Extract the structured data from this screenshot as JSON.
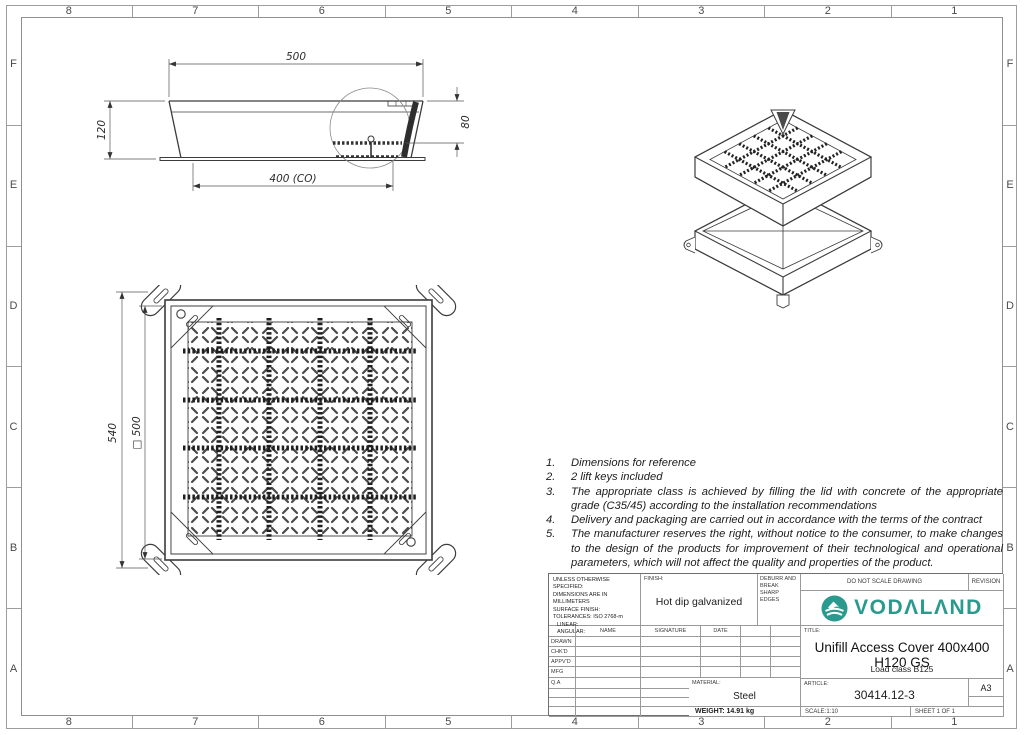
{
  "sheet": {
    "grid_columns": [
      "8",
      "7",
      "6",
      "5",
      "4",
      "3",
      "2",
      "1"
    ],
    "grid_rows": [
      "F",
      "E",
      "D",
      "C",
      "B",
      "A"
    ]
  },
  "views": {
    "side_view": {
      "dim_width_top": "500",
      "dim_height_left": "120",
      "dim_height_right": "80",
      "dim_clear_opening": "400 (CO)"
    },
    "plan_view": {
      "dim_outer_height": "540",
      "dim_inner_square": "□ 500"
    }
  },
  "notes": {
    "items": [
      {
        "num": "1.",
        "text": "Dimensions for reference"
      },
      {
        "num": "2.",
        "text": "2 lift keys included"
      },
      {
        "num": "3.",
        "text": "The appropriate class is achieved by filling the lid with concrete of the appropriate grade (C35/45) according to the installation recommendations"
      },
      {
        "num": "4.",
        "text": "Delivery and packaging are carried out in accordance with the terms of the contract"
      },
      {
        "num": "5.",
        "text": "The manufacturer reserves the right, without notice to the consumer, to make changes to the design of the products for improvement of their technological and operational parameters, which will not affect the quality and properties of the product."
      }
    ]
  },
  "title_block": {
    "tolerance_lines": [
      "UNLESS OTHERWISE SPECIFIED:",
      "DIMENSIONS ARE IN MILLIMETERS",
      "SURFACE FINISH:",
      "TOLERANCES: ISO 2768-m",
      "LINEAR:",
      "ANGULAR:"
    ],
    "finish_label": "FINISH:",
    "finish_value": "Hot dip galvanized",
    "deburr_text": "DEBURR AND BREAK SHARP EDGES",
    "do_not_scale": "DO NOT SCALE DRAWING",
    "revision_label": "REVISION",
    "brand_name": "VODΛLΛND",
    "brand_color": "#2a9a8e",
    "table_columns": [
      "NAME",
      "SIGNATURE",
      "DATE"
    ],
    "approval_rows": [
      "DRAWN",
      "CHK'D",
      "APPV'D",
      "MFG",
      "Q.A"
    ],
    "title_label": "TITLE:",
    "title": "Unifill Access Cover 400x400 H120 GS",
    "load_class": "Load class B125",
    "material_label": "MATERIAL:",
    "material_value": "Steel",
    "weight_text": "WEIGHT: 14.91 kg",
    "article_label": "ARTICLE:",
    "article_number": "30414.12-3",
    "paper_size": "A3",
    "scale_text": "SCALE:1:10",
    "sheet_text": "SHEET 1 OF 1"
  }
}
